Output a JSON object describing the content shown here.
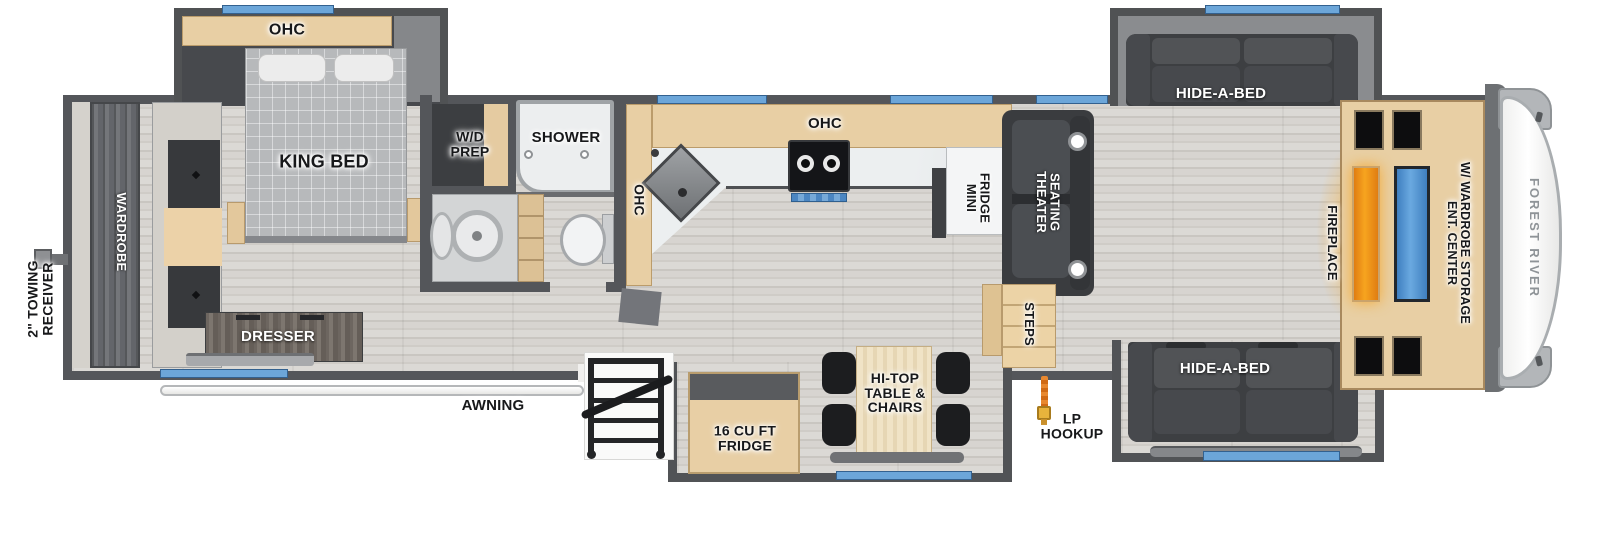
{
  "plan": {
    "brand_logo": "FOREST RIVER",
    "exterior": {
      "towing_receiver": "2\" TOWING\nRECEIVER",
      "awning": "AWNING",
      "lp_hookup": "LP\nHOOKUP"
    },
    "bedroom": {
      "ohc": "OHC",
      "king_bed": "KING BED",
      "wardrobe": "WARDROBE",
      "dresser": "DRESSER"
    },
    "bathroom": {
      "wd_prep": "W/D\nPREP",
      "shower": "SHOWER"
    },
    "kitchen": {
      "ohc_side": "OHC",
      "ohc_top": "OHC",
      "mini_fridge": "MINI\nFRIDGE",
      "fridge_16": "16 CU FT\nFRIDGE",
      "hitop_table": "HI-TOP\nTABLE &\nCHAIRS"
    },
    "living": {
      "theater_seating": "THEATER\nSEATING",
      "steps": "STEPS",
      "hide_a_bed_top": "HIDE-A-BED",
      "hide_a_bed_bottom": "HIDE-A-BED",
      "fireplace": "FIREPLACE",
      "ent_center": "ENT. CENTER\nW/ WARDROBE STORAGE"
    },
    "icons": {
      "window": "blue-strip",
      "towing_hitch": "hitch-block",
      "lp_hose": "orange-hose",
      "entry_steps": "fold-out-steps",
      "awning_rail": "white-tube"
    },
    "colors": {
      "wall": "#54565a",
      "cabinet_wood": "#e8cfa4",
      "window_blue": "#6ca6d9",
      "fireplace_glow": "#f5a01d",
      "tv_screen": "#4e90cf",
      "sofa_charcoal": "#3d3f42"
    }
  }
}
